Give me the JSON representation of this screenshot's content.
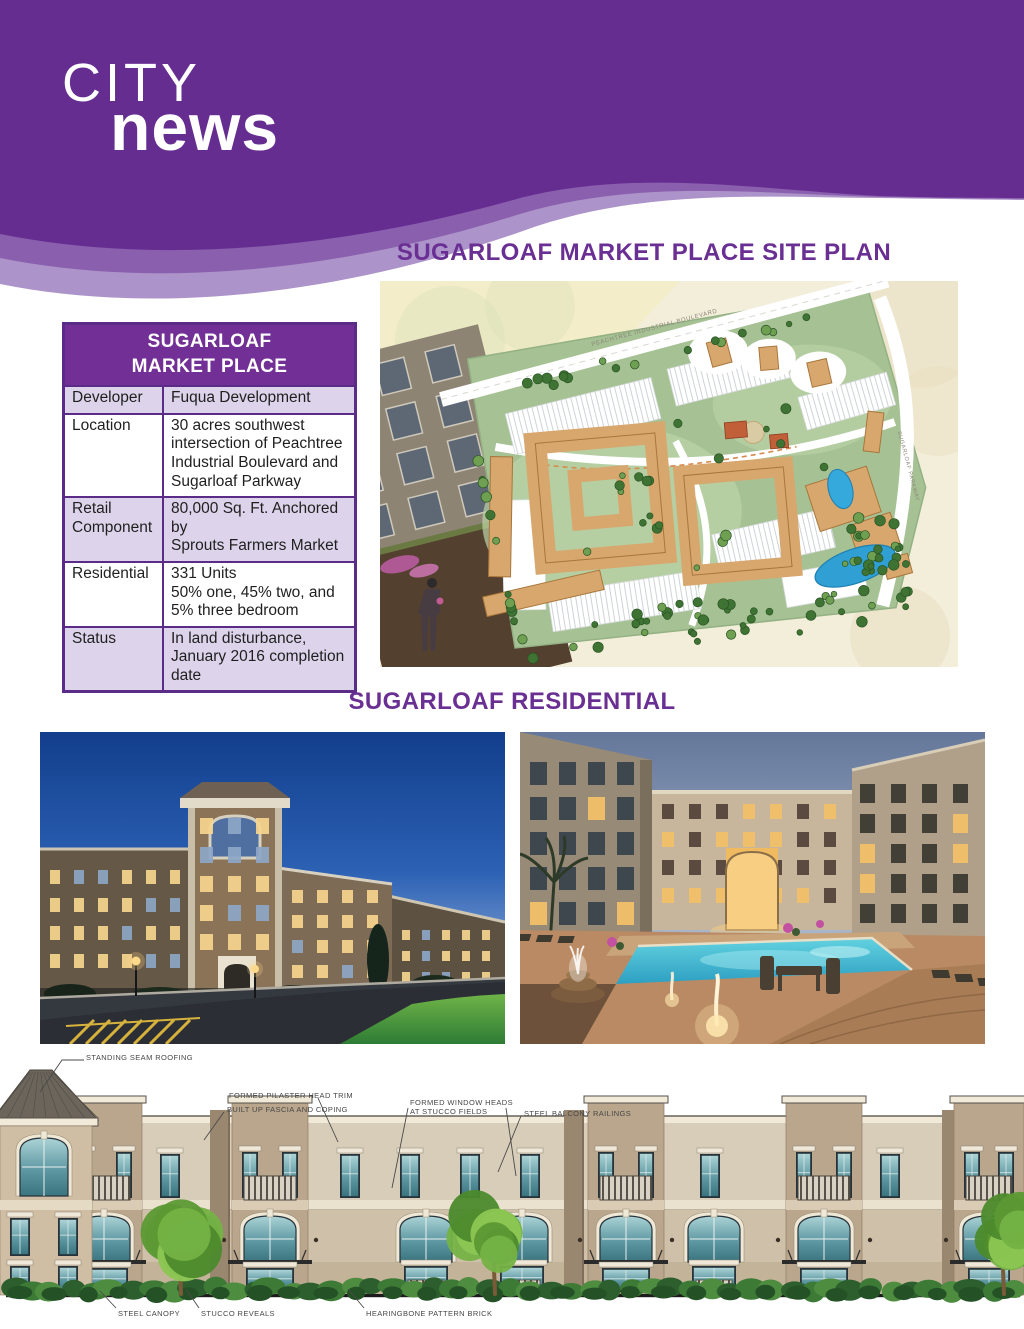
{
  "header": {
    "brand_line1": "CITY",
    "brand_line2": "news"
  },
  "colors": {
    "brand_purple": "#662D91",
    "ribbon_mid_purple": "#8A5FAE",
    "ribbon_light_purple": "#AC93C9",
    "heading_purple": "#6A2F93",
    "table_alt_row": "#DDD3EA"
  },
  "site_plan": {
    "title": "SUGARLOAF MARKET PLACE SITE PLAN",
    "road_label_top": "PEACHTREE INDUSTRIAL BOULEVARD",
    "road_label_right": "SUGARLOAF PARKWAY"
  },
  "table": {
    "title_line1": "SUGARLOAF",
    "title_line2": "MARKET PLACE",
    "rows": [
      {
        "label": "Developer",
        "value": "Fuqua Development"
      },
      {
        "label": "Location",
        "value": "30 acres southwest\nintersection of Peachtree\nIndustrial Boulevard and\nSugarloaf Parkway"
      },
      {
        "label": "Retail Component",
        "value": "80,000 Sq. Ft. Anchored by\nSprouts Farmers Market"
      },
      {
        "label": "Residential",
        "value": "331 Units\n50% one, 45% two, and\n5% three bedroom"
      },
      {
        "label": "Status",
        "value": "In land disturbance,\nJanuary 2016 completion\ndate"
      }
    ]
  },
  "residential": {
    "title": "SUGARLOAF RESIDENTIAL"
  },
  "elevation": {
    "labels": {
      "roofing": "STANDING SEAM ROOFING",
      "pilaster": "FORMED PILASTER HEAD TRIM",
      "fascia": "BUILT UP FASCIA AND COPING",
      "window_heads": "FORMED WINDOW HEADS\nAT STUCCO FIELDS",
      "balcony": "STEEL BALCONY RAILINGS",
      "canopy": "STEEL CANOPY",
      "reveals": "STUCCO REVEALS",
      "brick": "HEARINGBONE PATTERN BRICK"
    }
  }
}
